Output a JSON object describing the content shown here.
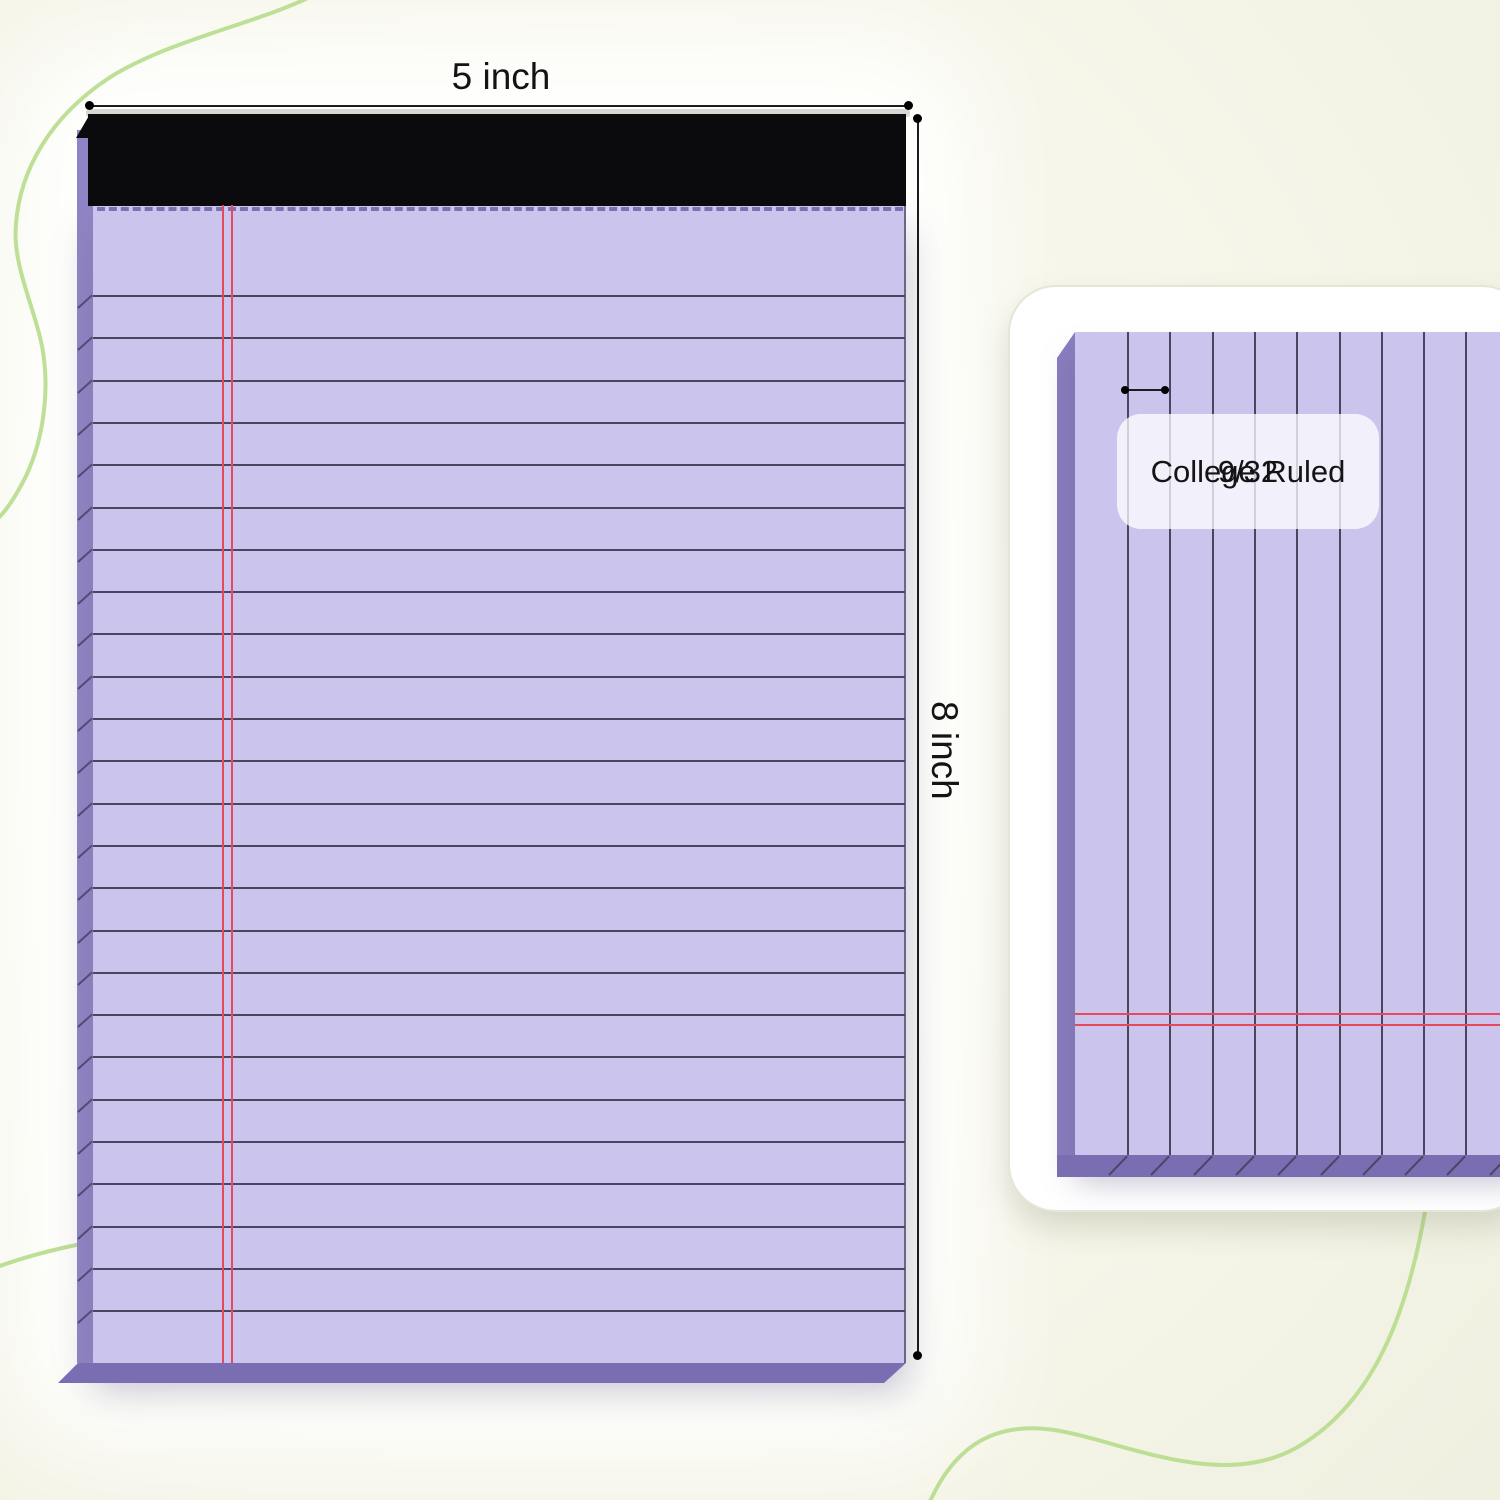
{
  "product_diagram": {
    "left_pad": {
      "width_dimension": "5 inch",
      "height_dimension": "8 inch"
    },
    "detail_card": {
      "ruling_fraction": "9/32",
      "ruling_name": "College Ruled"
    },
    "colors": {
      "paper": "#cbc5ee",
      "spine": "#9184c6",
      "spine2": "#8a7dc0",
      "spine-dark": "#7a6db2",
      "binding": "#0b0b0e",
      "rule": "#4a4560",
      "red": "#e8485e",
      "perf": "#6f64a8",
      "squiggle": "#b9dd90"
    },
    "ruling": {
      "left_line_count": 25,
      "left_first_line_y": 295,
      "line_spacing": 42.3,
      "left_rule_x": 93,
      "left_rule_width": 812,
      "left_red_line_x": [
        222,
        231
      ],
      "red_line_top": 205,
      "red_line_height": 1158,
      "detail_card_origin": [
        1008,
        285
      ],
      "detail_first_line_x": 1125,
      "detail_line_count": 10,
      "detail_rule_top_local": 45,
      "detail_rule_height": 823,
      "detail_red_line_y": [
        1011,
        1022
      ],
      "detail_red_x_local": 65,
      "detail_red_width": 455
    }
  }
}
